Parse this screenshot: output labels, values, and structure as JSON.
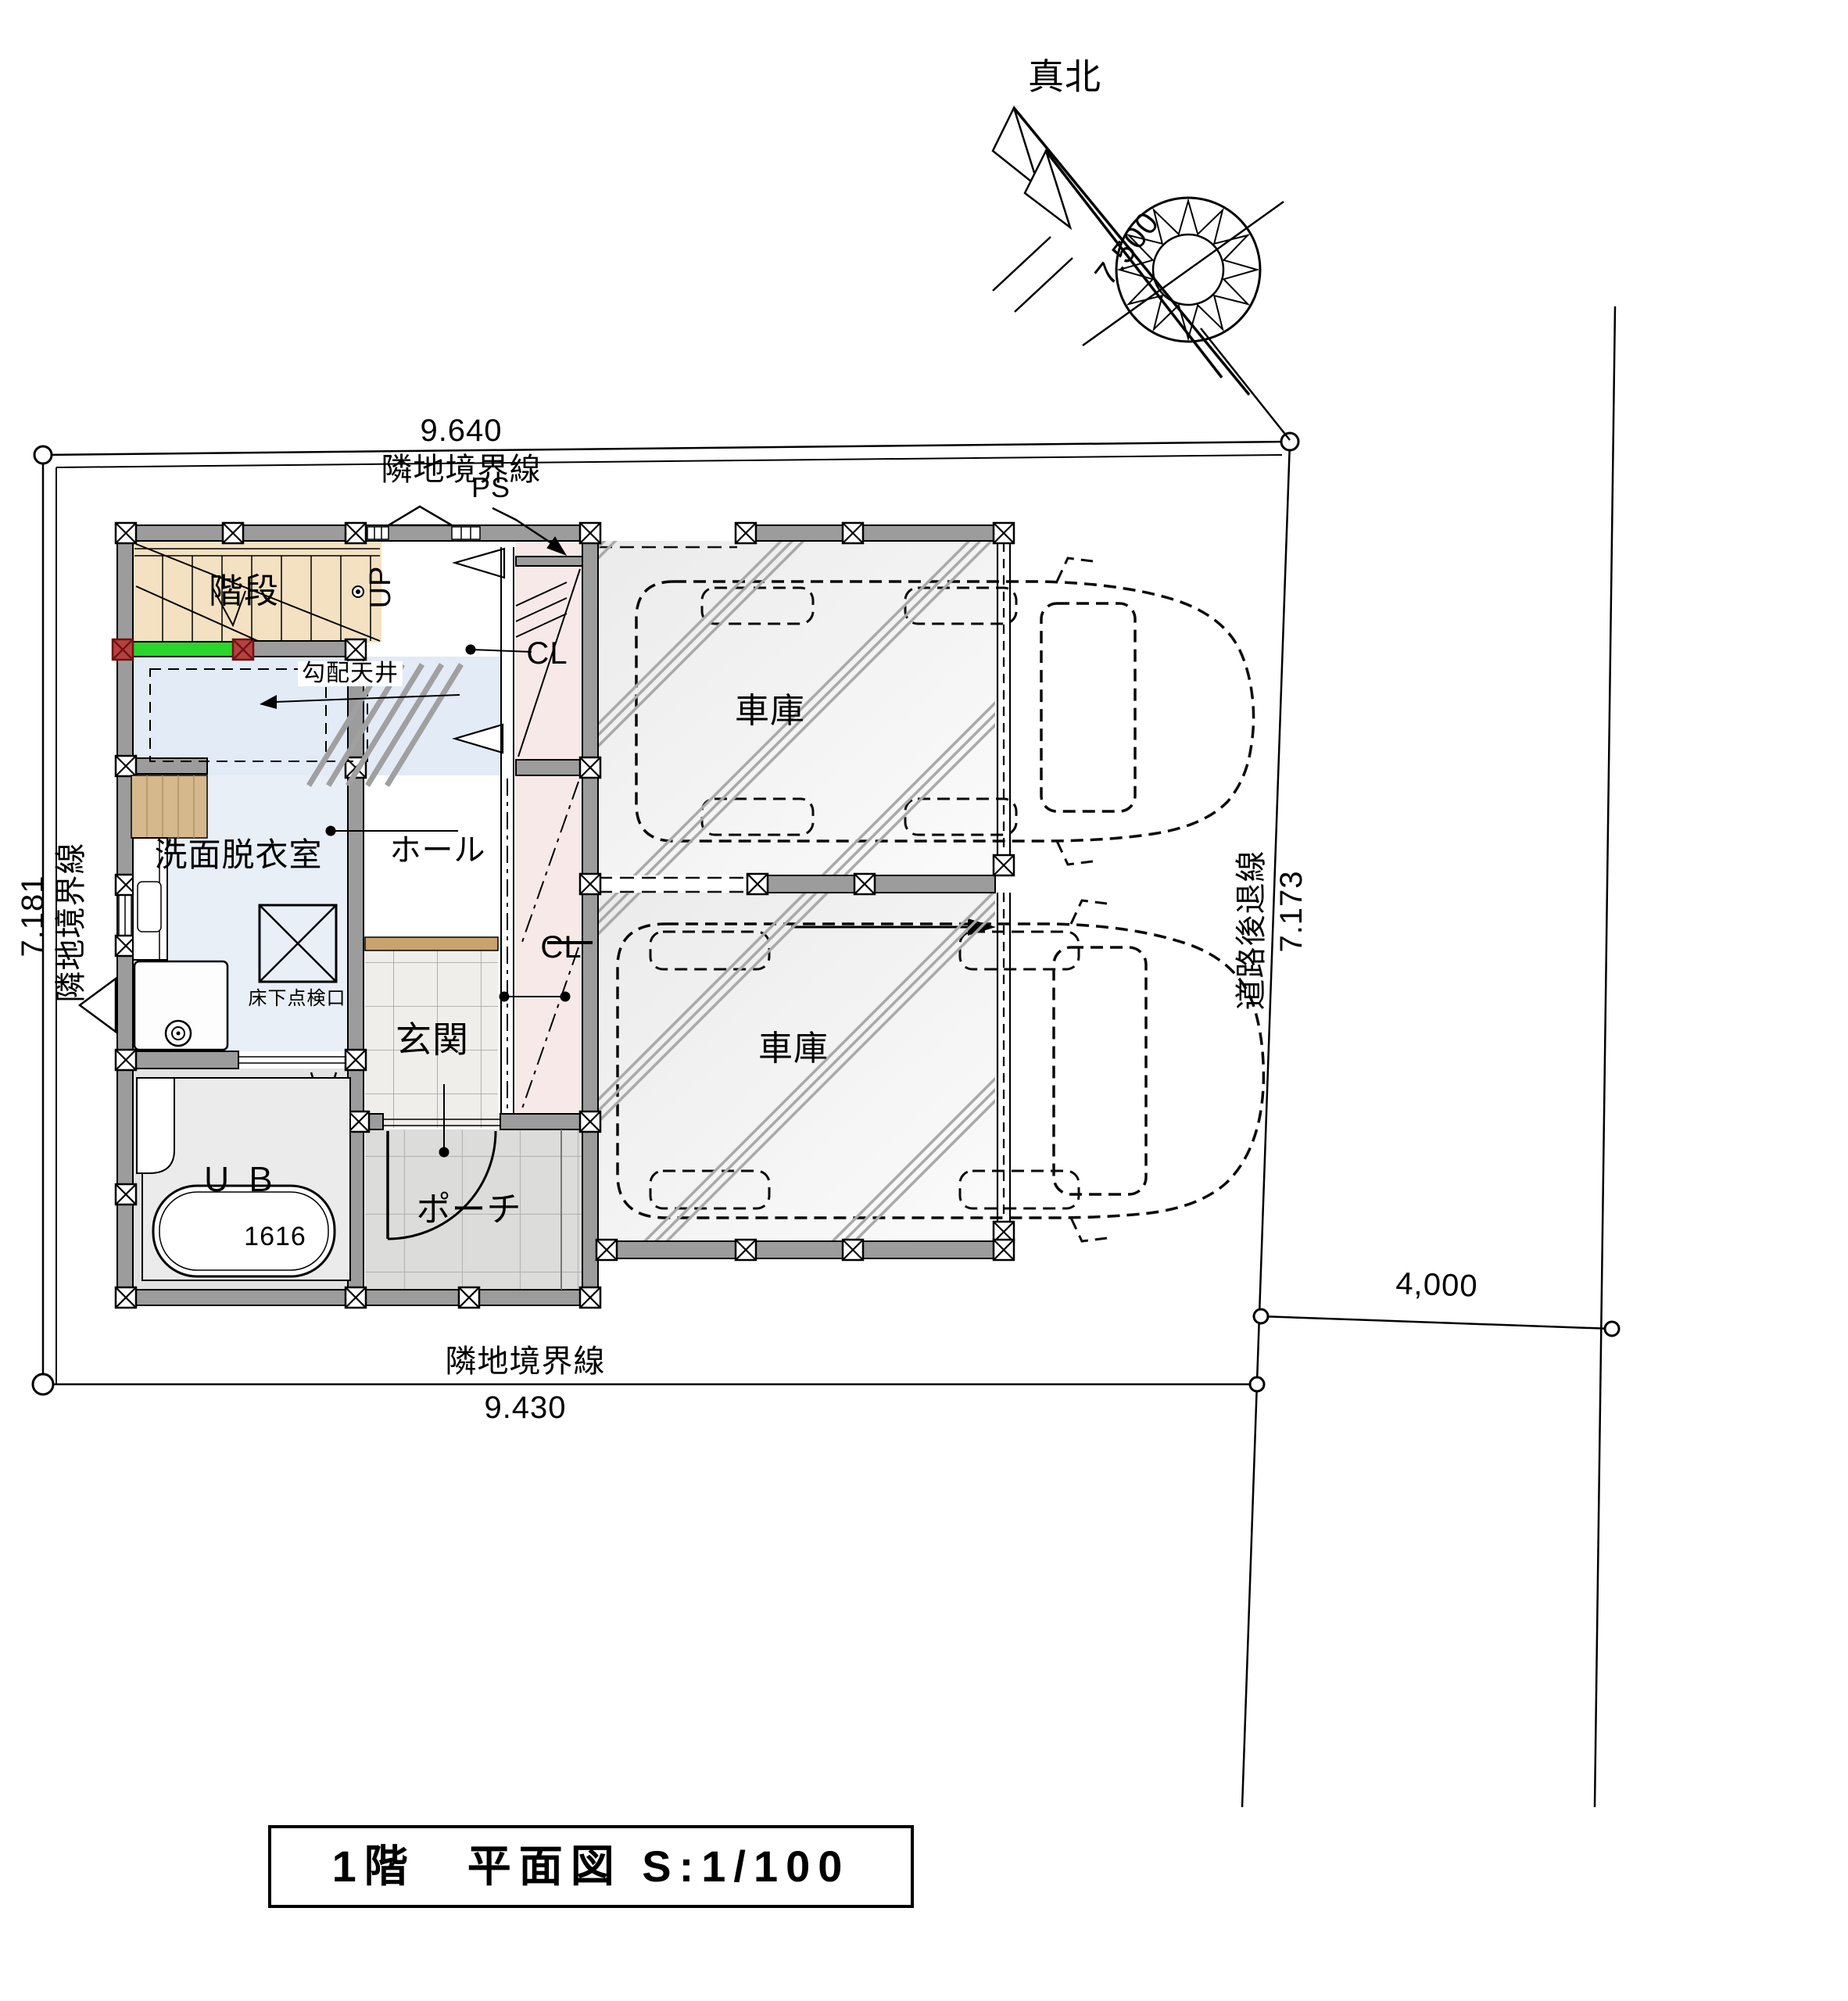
{
  "title_block": {
    "text": "1階　平面図 S:1/100"
  },
  "compass": {
    "north_label": "真北",
    "shaft_dim": "7.500"
  },
  "boundaries": {
    "top_label": "隣地境界線",
    "left_label": "隣地境界線",
    "bottom_label": "隣地境界線",
    "road_setback_label": "道路後退線"
  },
  "dims": {
    "top": "9.640",
    "left": "7.181",
    "right": "7.173",
    "bottom": "9.430",
    "road_width": "4,000"
  },
  "rooms": {
    "stairs": "階段",
    "hall": "ホール",
    "washroom": "洗面脱衣室",
    "entrance": "玄関",
    "porch": "ポーチ",
    "bath": "ＵＢ",
    "garage_upper": "車庫",
    "garage_lower": "車庫"
  },
  "fixtures": {
    "bathtub_size": "1616",
    "pipe_space": "PS",
    "closet_upper": "CL",
    "closet_lower": "CL",
    "up_label": "UP",
    "sloped_ceiling": "勾配天井",
    "floor_hatch": "床下点検口"
  }
}
